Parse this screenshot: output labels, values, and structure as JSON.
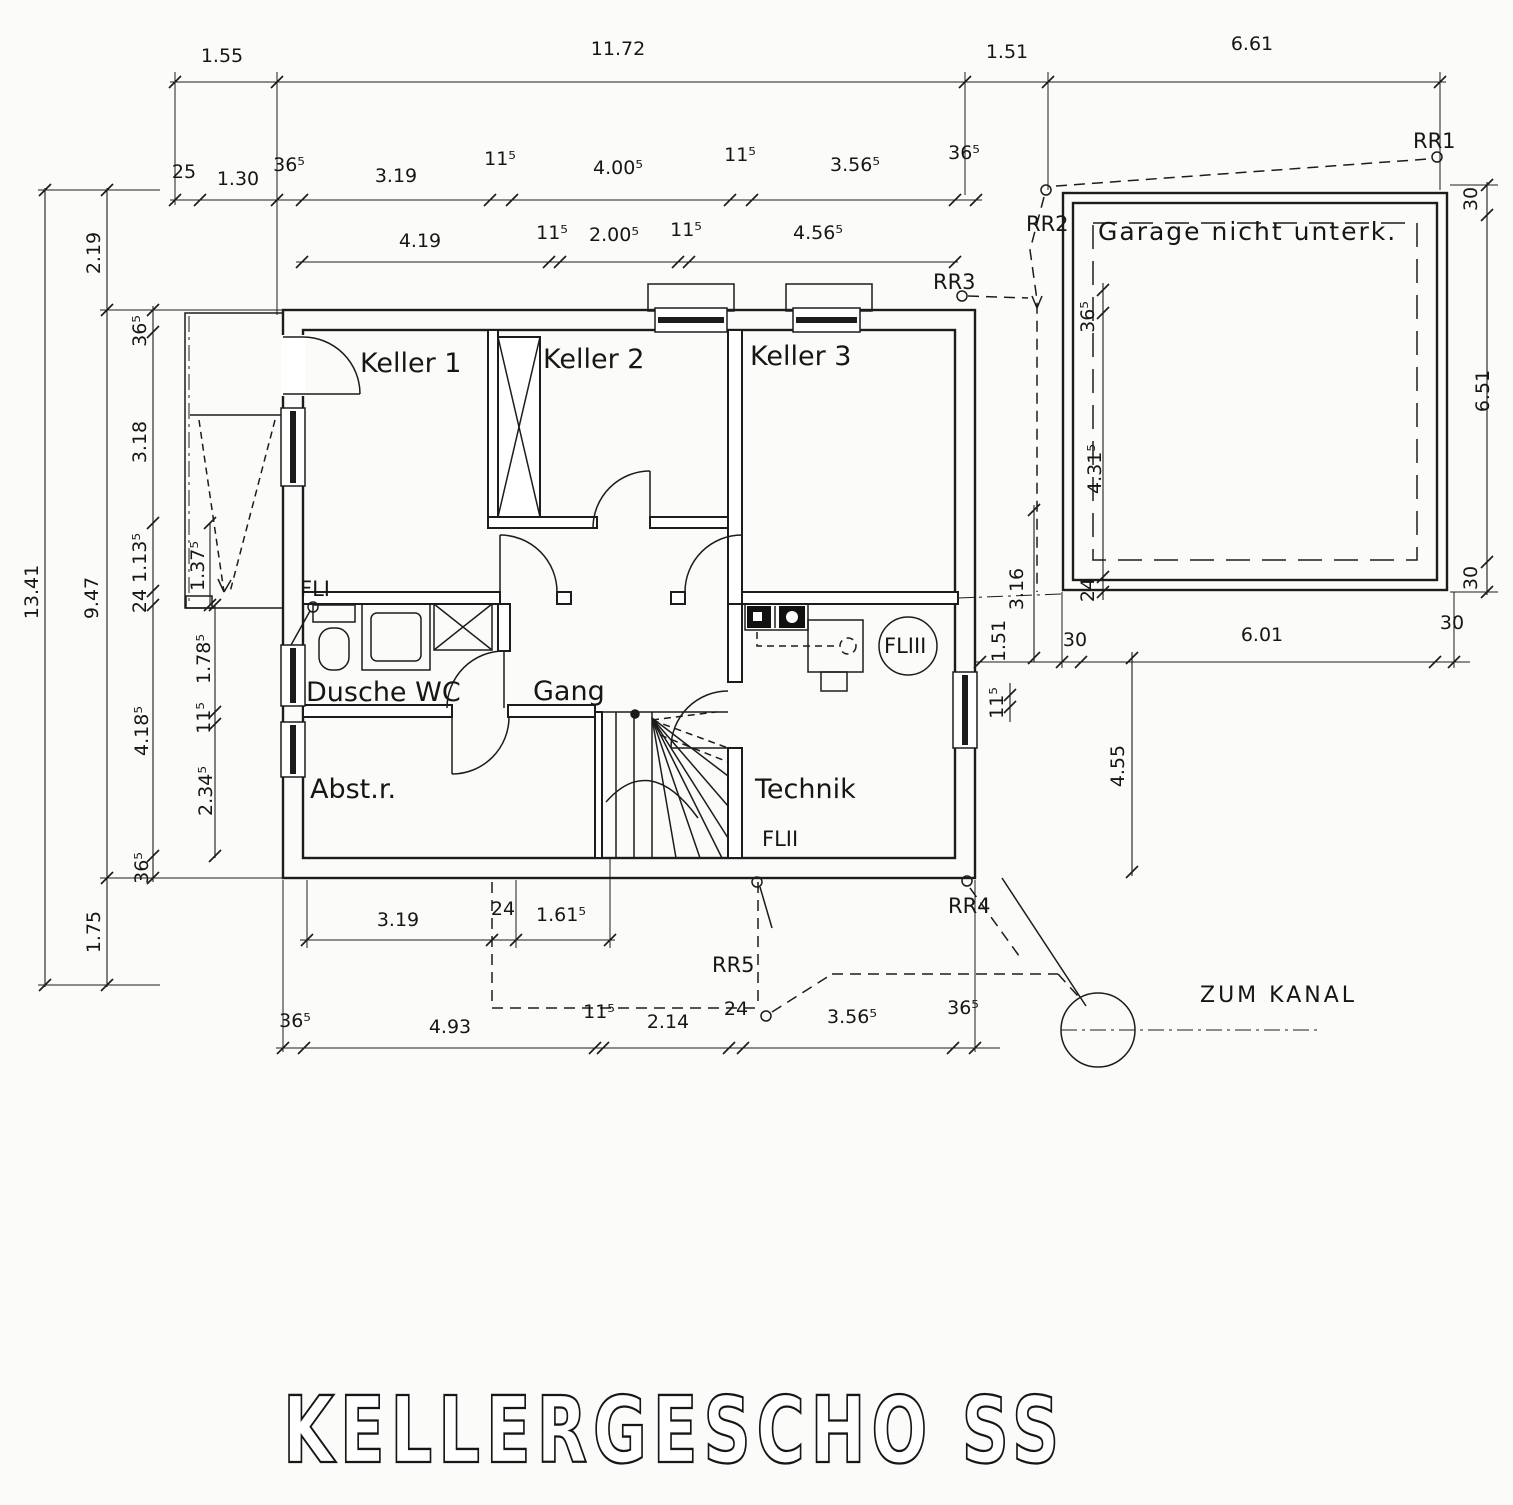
{
  "title": "KELLERGESCHO SS",
  "rooms": {
    "keller1": "Keller 1",
    "keller2": "Keller 2",
    "keller3": "Keller 3",
    "dusche_wc": "Dusche WC",
    "gang": "Gang",
    "abstellraum": "Abst.r.",
    "technik": "Technik"
  },
  "garage": {
    "label": "Garage nicht unterk."
  },
  "drainage": {
    "rr1": "RR1",
    "rr2": "RR2",
    "rr3": "RR3",
    "rr4": "RR4",
    "rr5": "RR5",
    "fl1": "FLI",
    "fl2": "FLII",
    "fl3": "FLIII",
    "zum_kanal": "ZUM KANAL"
  },
  "dimension_labels": [
    {
      "t": "1.55",
      "x": 222,
      "y": 62,
      "r": 0
    },
    {
      "t": "11.72",
      "x": 618,
      "y": 55,
      "r": 0
    },
    {
      "t": "1.51",
      "x": 1007,
      "y": 58,
      "r": 0
    },
    {
      "t": "6.61",
      "x": 1252,
      "y": 50,
      "r": 0
    },
    {
      "t": "25",
      "x": 184,
      "y": 178,
      "r": 0
    },
    {
      "t": "1.30",
      "x": 238,
      "y": 185,
      "r": 0
    },
    {
      "t": "36⁵",
      "x": 289,
      "y": 171,
      "r": 0
    },
    {
      "t": "3.19",
      "x": 396,
      "y": 182,
      "r": 0
    },
    {
      "t": "11⁵",
      "x": 500,
      "y": 165,
      "r": 0
    },
    {
      "t": "4.00⁵",
      "x": 618,
      "y": 174,
      "r": 0
    },
    {
      "t": "11⁵",
      "x": 740,
      "y": 161,
      "r": 0
    },
    {
      "t": "3.56⁵",
      "x": 855,
      "y": 171,
      "r": 0
    },
    {
      "t": "36⁵",
      "x": 964,
      "y": 159,
      "r": 0
    },
    {
      "t": "4.19",
      "x": 420,
      "y": 247,
      "r": 0
    },
    {
      "t": "11⁵",
      "x": 552,
      "y": 239,
      "r": 0
    },
    {
      "t": "2.00⁵",
      "x": 614,
      "y": 241,
      "r": 0
    },
    {
      "t": "11⁵",
      "x": 686,
      "y": 236,
      "r": 0
    },
    {
      "t": "4.56⁵",
      "x": 818,
      "y": 239,
      "r": 0
    },
    {
      "t": "13.41",
      "x": 38,
      "y": 592,
      "r": -90
    },
    {
      "t": "2.19",
      "x": 100,
      "y": 253,
      "r": -90
    },
    {
      "t": "9.47",
      "x": 98,
      "y": 598,
      "r": -90
    },
    {
      "t": "1.75",
      "x": 100,
      "y": 932,
      "r": -90
    },
    {
      "t": "36⁵",
      "x": 146,
      "y": 331,
      "r": -90
    },
    {
      "t": "3.18",
      "x": 146,
      "y": 442,
      "r": -90
    },
    {
      "t": "1.13⁵",
      "x": 146,
      "y": 558,
      "r": -90
    },
    {
      "t": "24",
      "x": 146,
      "y": 601,
      "r": -90
    },
    {
      "t": "4.18⁵",
      "x": 148,
      "y": 731,
      "r": -90
    },
    {
      "t": "36⁵",
      "x": 148,
      "y": 868,
      "r": -90
    },
    {
      "t": "1.37⁵",
      "x": 204,
      "y": 566,
      "r": -90
    },
    {
      "t": "1.78⁵",
      "x": 210,
      "y": 659,
      "r": -90
    },
    {
      "t": "11⁵",
      "x": 210,
      "y": 718,
      "r": -90
    },
    {
      "t": "2.34⁵",
      "x": 212,
      "y": 791,
      "r": -90
    },
    {
      "t": "3.16",
      "x": 1023,
      "y": 589,
      "r": -90
    },
    {
      "t": "1.51",
      "x": 1005,
      "y": 641,
      "r": -90
    },
    {
      "t": "11⁵",
      "x": 1003,
      "y": 703,
      "r": -90
    },
    {
      "t": "4.55",
      "x": 1124,
      "y": 766,
      "r": -90
    },
    {
      "t": "30",
      "x": 1477,
      "y": 199,
      "r": -90
    },
    {
      "t": "6.51",
      "x": 1489,
      "y": 391,
      "r": -90
    },
    {
      "t": "30",
      "x": 1477,
      "y": 578,
      "r": -90
    },
    {
      "t": "36⁵",
      "x": 1094,
      "y": 317,
      "r": -90
    },
    {
      "t": "4.31⁵",
      "x": 1101,
      "y": 469,
      "r": -90
    },
    {
      "t": "24",
      "x": 1094,
      "y": 590,
      "r": -90
    },
    {
      "t": "30",
      "x": 1075,
      "y": 646,
      "r": 0
    },
    {
      "t": "6.01",
      "x": 1262,
      "y": 641,
      "r": 0
    },
    {
      "t": "30",
      "x": 1452,
      "y": 629,
      "r": 0
    },
    {
      "t": "3.19",
      "x": 398,
      "y": 926,
      "r": 0
    },
    {
      "t": "24",
      "x": 503,
      "y": 915,
      "r": 0
    },
    {
      "t": "1.61⁵",
      "x": 561,
      "y": 921,
      "r": 0
    },
    {
      "t": "36⁵",
      "x": 295,
      "y": 1027,
      "r": 0
    },
    {
      "t": "4.93",
      "x": 450,
      "y": 1033,
      "r": 0
    },
    {
      "t": "11⁵",
      "x": 599,
      "y": 1018,
      "r": 0
    },
    {
      "t": "2.14",
      "x": 668,
      "y": 1028,
      "r": 0
    },
    {
      "t": "24",
      "x": 736,
      "y": 1015,
      "r": 0
    },
    {
      "t": "3.56⁵",
      "x": 852,
      "y": 1023,
      "r": 0
    },
    {
      "t": "36⁵",
      "x": 963,
      "y": 1014,
      "r": 0
    }
  ]
}
